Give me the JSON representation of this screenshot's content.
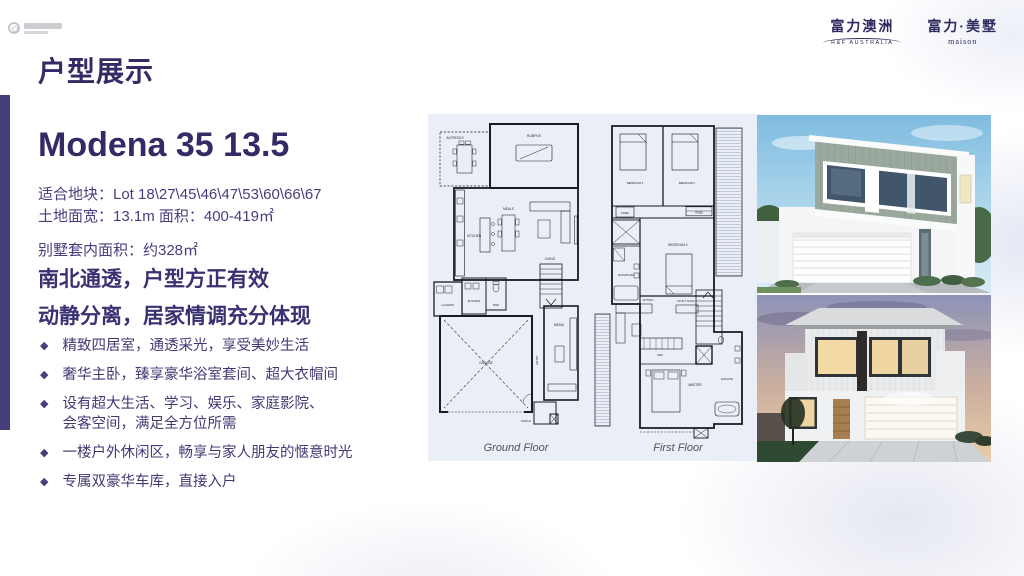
{
  "header": {
    "title": "户型展示"
  },
  "logos": {
    "rf_cn": "富力澳洲",
    "rf_en": "R&F AUSTRALIA",
    "maison_cn": "富力·美墅",
    "maison_en": "maison"
  },
  "model": {
    "name": "Modena 35 13.5"
  },
  "specs": {
    "lots": "适合地块：Lot 18\\27\\45\\46\\47\\53\\60\\66\\67",
    "frontage_area": "土地面宽：13.1m  面积：400-419㎡",
    "internal_area": "别墅套内面积：约328㎡"
  },
  "headlines": {
    "line1": "南北通透，户型方正有效",
    "line2": "动静分离，居家情调充分体现"
  },
  "bullet_glyph": "◆",
  "bullets": [
    "精致四居室，通透采光，享受美妙生活",
    "奢华主卧，臻享豪华浴室套间、超大衣帽间",
    "设有超大生活、学习、娱乐、家庭影院、\n会客空间，满足全方位所需",
    "一楼户外休闲区，畅享与家人朋友的惬意时光",
    "专属双豪华车库，直接入户"
  ],
  "floorplan": {
    "ground": {
      "label": "Ground Floor",
      "rooms": [
        "ALFRESCO",
        "RUMPUS",
        "KITCHEN",
        "MEALS",
        "LIVING",
        "LAUNDRY",
        "BUTLERS",
        "PWD",
        "GARAGE",
        "ENTRY",
        "MEDIA",
        "PORCH"
      ]
    },
    "first": {
      "label": "First Floor",
      "rooms": [
        "BEDROOM 3",
        "BEDROOM 2",
        "ROBE",
        "ROBE",
        "BEDROOM 4",
        "BATHROOM",
        "SITTING",
        "STUDY NOOK",
        "WIR",
        "MASTER",
        "ENSUITE"
      ]
    }
  },
  "colors": {
    "accent_purple": "#453e7d",
    "text_purple": "#403a74",
    "panel_blue": "#e9eef7",
    "logo_navy": "#2f2a5e"
  }
}
